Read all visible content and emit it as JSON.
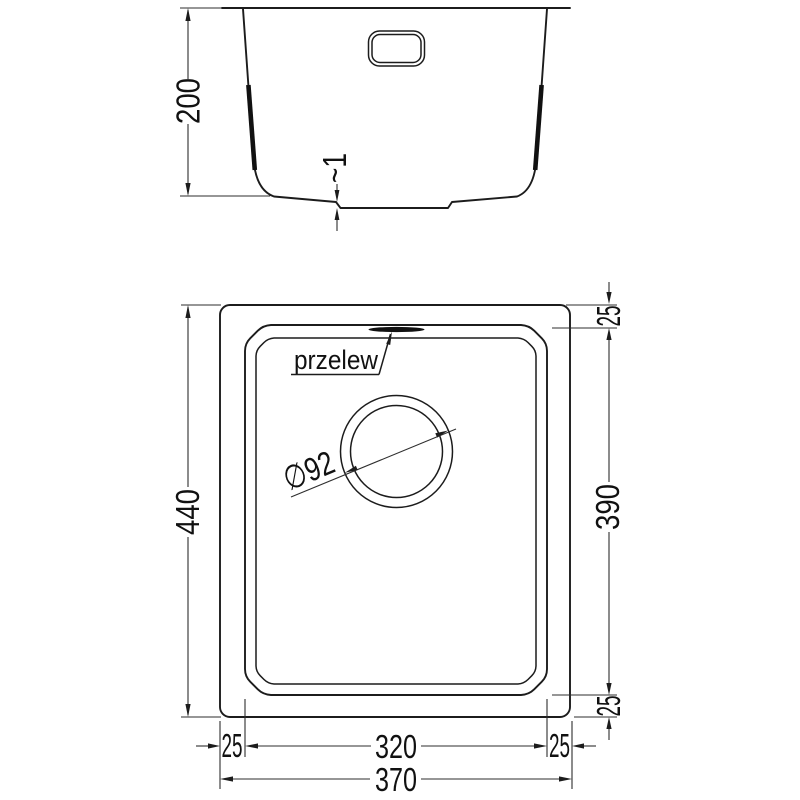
{
  "drawing": {
    "background_color": "#ffffff",
    "line_color": "#1c1c1c",
    "dimension_color": "#2e2e2e",
    "text_color": "#111111"
  },
  "side_view": {
    "depth_dim": "200",
    "bottom_step_dim": "~1"
  },
  "plan_view": {
    "overflow_label": "przelew",
    "drain_diameter_dim": "∅92",
    "overall_length_dim": "440",
    "overall_width_dim": "370",
    "bowl_width_dim": "320",
    "bowl_length_dim": "390",
    "rim_offset_top_dim": "25",
    "rim_offset_bottom_dim": "25",
    "rim_offset_left_dim": "25",
    "rim_offset_right_dim": "25"
  }
}
